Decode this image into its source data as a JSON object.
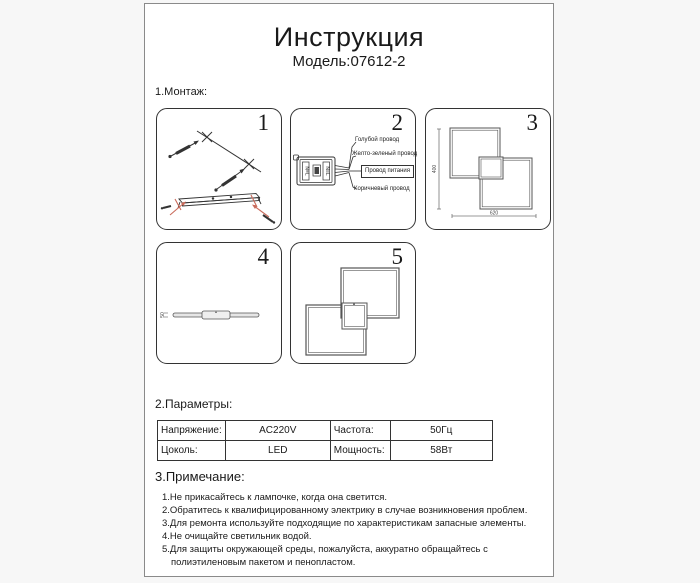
{
  "header": {
    "title": "Инструкция",
    "model": "Модель:07612-2"
  },
  "sections": {
    "montage": "1.Монтаж:",
    "parameters": "2.Параметры:",
    "notes": "3.Примечание:"
  },
  "panels": {
    "p1": {
      "number": "1"
    },
    "p2": {
      "number": "2",
      "terminals": "N≡L",
      "wires": {
        "blue": "Голубой провод",
        "yellow_green": "Желто-зеленый провод",
        "power": "Провод питания",
        "brown": "Коричневый провод"
      }
    },
    "p3": {
      "number": "3",
      "dim_height": "400",
      "dim_width": "620"
    },
    "p4": {
      "number": "4",
      "dim_thickness": "50"
    },
    "p5": {
      "number": "5"
    }
  },
  "parameters_table": {
    "rows": [
      {
        "c0": "Напряжение:",
        "c1": "AC220V",
        "c2": "Частота:",
        "c3": "50Гц"
      },
      {
        "c0": "Цоколь:",
        "c1": "LED",
        "c2": "Мощность:",
        "c3": "58Вт"
      }
    ]
  },
  "notes_list": [
    "1.Не прикасайтесь к лампочке, когда она светится.",
    "2.Обратитесь к квалифицированному электрику в случае возникновения проблем.",
    "3.Для ремонта используйте подходящие по характеристикам запасные элементы.",
    "4.Не очищайте светильник водой.",
    "5.Для защиты окружающей среды, пожалуйста, аккуратно обращайтесь с полиэтиленовым пакетом и пенопластом."
  ],
  "colors": {
    "line": "#333333",
    "accent_red": "#c96a5a",
    "page_border": "#8a8a8a"
  }
}
